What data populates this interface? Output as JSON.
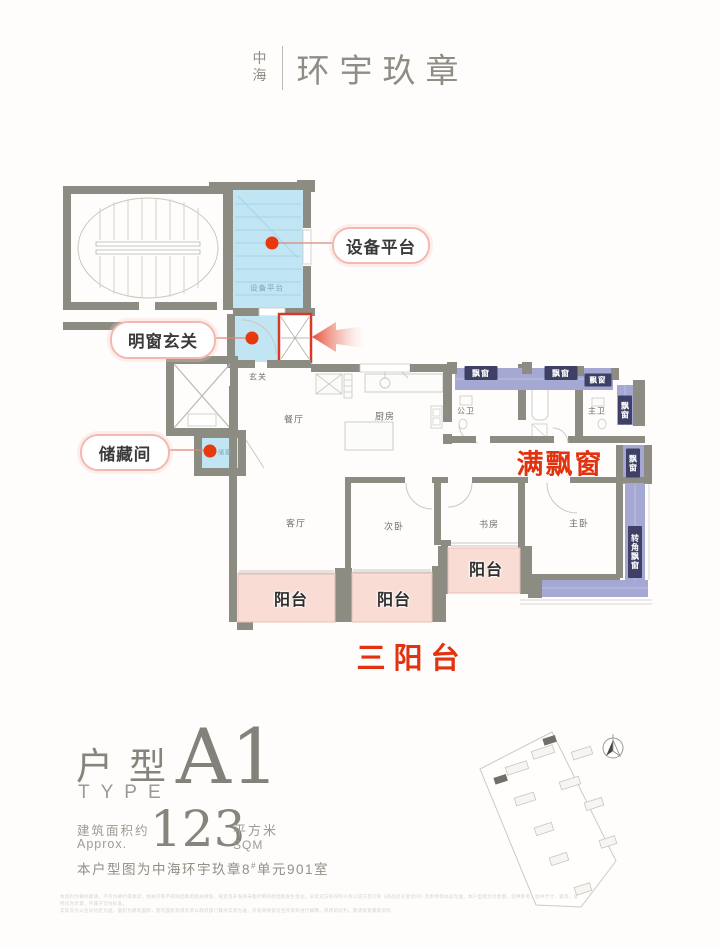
{
  "brand": {
    "mark": "中海",
    "name": "环宇玖章"
  },
  "callouts": {
    "equipment": "设备平台",
    "bright_entry": "明窗玄关",
    "storage": "储藏间"
  },
  "highlights": {
    "full_bay": "满飘窗",
    "three_balconies": "三阳台"
  },
  "rooms": {
    "entry": "玄关",
    "dining": "餐厅",
    "kitchen": "厨房",
    "bath": "公卫",
    "master_bath": "主卫",
    "living": "客厅",
    "bedroom2": "次卧",
    "study": "书房",
    "master": "主卧",
    "equipment": "设备平台",
    "storage": "储藏"
  },
  "bay": {
    "label": "飘窗",
    "corner": "转角飘窗"
  },
  "balcony": {
    "label": "阳台"
  },
  "type_block": {
    "cn": "户型",
    "en": "TYPE",
    "code": "A1",
    "area_label_cn": "建筑面积约",
    "area_label_en": "Approx.",
    "area_value": "123",
    "unit_cn": "平方米",
    "unit_en": "SQM",
    "note_prefix": "本户型图为中海环宇玖章8",
    "note_sup": "#",
    "note_suffix": "单元901室"
  },
  "site_plan": {
    "north": "N"
  },
  "disclaimer": {
    "line1": "本资料为要约邀请，不作为要约或承诺，相关内容不排除因政府相关规划、规定及开发商未能控制的原因而发生变化，买卖双方的权利义务以双方签订的《商品房买卖合同》及附件等协议为准。本户型图为示意图，仅供参考，图中尺寸、家具、装修仅为示意，不属于交付标准，",
    "line2": "实际交付以合同约定为准。面积为建筑面积，套内面积及得房率以政府部门最终实测为准。开发商保留对宣传资料进行解释、修改的权利。敬请留意最新资料。"
  },
  "colors": {
    "accent_red": "#e23310",
    "bay_navy": "#3e4165",
    "bay_purple": "#a5a8d2",
    "platform_blue": "#c2e5f4",
    "balcony_pink": "#f9dcd3",
    "wall_gray": "#8c8c82"
  }
}
